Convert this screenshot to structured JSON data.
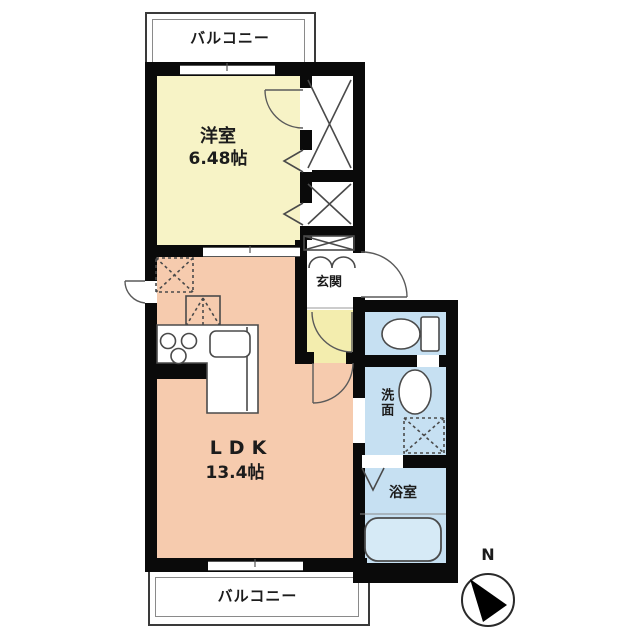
{
  "labels": {
    "balcony_top": "バルコニー",
    "balcony_bottom": "バルコニー",
    "west_room_name": "洋室",
    "west_room_size": "6.48帖",
    "ldk_name": "LDK",
    "ldk_size": "13.4帖",
    "entrance": "玄関",
    "washroom": "洗面",
    "bathroom": "浴室",
    "compass_north": "N"
  },
  "colors": {
    "wall": "#0a0a0a",
    "west_room_fill": "#f7f3c6",
    "hallway_fill": "#f3edae",
    "ldk_fill": "#f6cbae",
    "wet_area_fill": "#c6e0f2",
    "bathtub_fill": "#d6eaf6",
    "fixture_line": "#4a4a4a",
    "balcony_border": "#3a3a3a"
  }
}
